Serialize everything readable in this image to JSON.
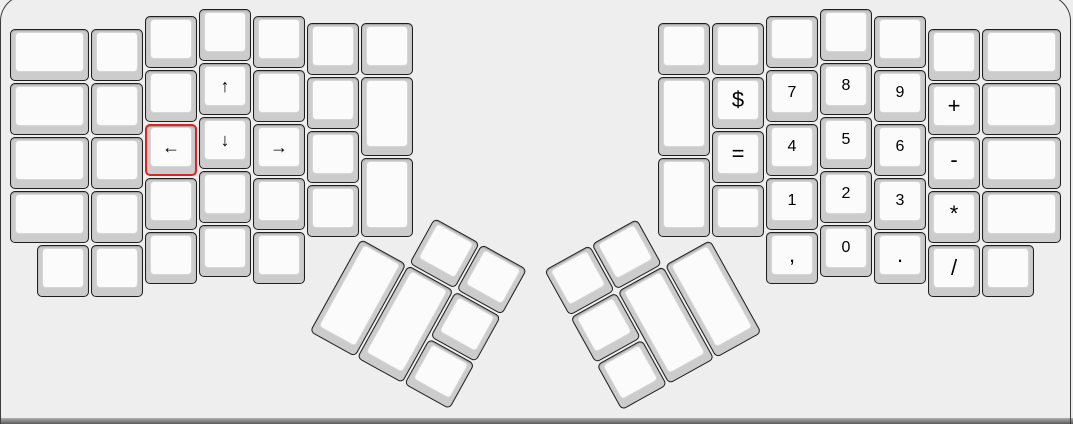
{
  "colors": {
    "page_background": "#eeeeee",
    "key_base": "#cccccc",
    "key_top": "#fbfbfb",
    "key_border": "#1f1f1f",
    "selected_key_border": "#e12222",
    "legend_color": "#000000",
    "panel_frame": "#3d3d3d",
    "bottom_edge": "#5a5a5a"
  },
  "keyboard": {
    "layout": {
      "unit_px": 54,
      "origin_x": 10,
      "origin_y": 9
    },
    "groups": [
      {
        "name": "left-main-keys",
        "rotation": 0,
        "keys": [
          {
            "x": 0,
            "y": 0.375,
            "w": 1.5,
            "label": ""
          },
          {
            "x": 0,
            "y": 1.375,
            "w": 1.5,
            "label": ""
          },
          {
            "x": 0,
            "y": 2.375,
            "w": 1.5,
            "label": ""
          },
          {
            "x": 0,
            "y": 3.375,
            "w": 1.5,
            "label": ""
          },
          {
            "x": 1.5,
            "y": 0.375,
            "label": ""
          },
          {
            "x": 1.5,
            "y": 1.375,
            "label": ""
          },
          {
            "x": 1.5,
            "y": 2.375,
            "label": ""
          },
          {
            "x": 1.5,
            "y": 3.375,
            "label": ""
          },
          {
            "x": 2.5,
            "y": 0.125,
            "label": ""
          },
          {
            "x": 2.5,
            "y": 1.125,
            "label": ""
          },
          {
            "x": 2.5,
            "y": 2.125,
            "label": "←",
            "cls": "arrow",
            "name": "key-left-arrow",
            "selected": true
          },
          {
            "x": 2.5,
            "y": 3.125,
            "label": ""
          },
          {
            "x": 3.5,
            "y": 0,
            "label": ""
          },
          {
            "x": 3.5,
            "y": 1,
            "label": "↑",
            "cls": "arrow",
            "name": "key-up-arrow"
          },
          {
            "x": 3.5,
            "y": 2,
            "label": "↓",
            "cls": "arrow",
            "name": "key-down-arrow"
          },
          {
            "x": 3.5,
            "y": 3,
            "label": ""
          },
          {
            "x": 4.5,
            "y": 0.125,
            "label": ""
          },
          {
            "x": 4.5,
            "y": 1.125,
            "label": ""
          },
          {
            "x": 4.5,
            "y": 2.125,
            "label": "→",
            "cls": "arrow",
            "name": "key-right-arrow"
          },
          {
            "x": 4.5,
            "y": 3.125,
            "label": ""
          },
          {
            "x": 5.5,
            "y": 0.25,
            "label": ""
          },
          {
            "x": 5.5,
            "y": 1.25,
            "label": ""
          },
          {
            "x": 5.5,
            "y": 2.25,
            "label": ""
          },
          {
            "x": 5.5,
            "y": 3.25,
            "label": ""
          },
          {
            "x": 6.5,
            "y": 0.25,
            "label": ""
          },
          {
            "x": 6.5,
            "y": 1.25,
            "h": 1.5,
            "label": ""
          },
          {
            "x": 6.5,
            "y": 2.75,
            "h": 1.5,
            "label": ""
          },
          {
            "x": 0.5,
            "y": 4.375,
            "label": ""
          },
          {
            "x": 1.5,
            "y": 4.375,
            "label": ""
          },
          {
            "x": 2.5,
            "y": 4.125,
            "label": ""
          },
          {
            "x": 3.5,
            "y": 4,
            "label": ""
          },
          {
            "x": 4.5,
            "y": 4.125,
            "label": ""
          }
        ]
      },
      {
        "name": "left-thumb-cluster",
        "rotation": 29,
        "center": {
          "x": 6.5,
          "y": 4.25
        },
        "keys": [
          {
            "x": 7.5,
            "y": 3.25,
            "label": ""
          },
          {
            "x": 8.5,
            "y": 3.25,
            "label": ""
          },
          {
            "x": 6.5,
            "y": 4.25,
            "h": 2,
            "label": ""
          },
          {
            "x": 7.5,
            "y": 4.25,
            "h": 2,
            "label": ""
          },
          {
            "x": 8.5,
            "y": 4.25,
            "label": ""
          },
          {
            "x": 8.5,
            "y": 5.25,
            "label": ""
          }
        ]
      },
      {
        "name": "right-main-keys",
        "rotation": 0,
        "keys": [
          {
            "x": 12,
            "y": 0.25,
            "label": ""
          },
          {
            "x": 12,
            "y": 1.25,
            "h": 1.5,
            "label": ""
          },
          {
            "x": 12,
            "y": 2.75,
            "h": 1.5,
            "label": ""
          },
          {
            "x": 13,
            "y": 0.25,
            "label": ""
          },
          {
            "x": 13,
            "y": 1.25,
            "label": "$",
            "cls": "symbol",
            "name": "key-dollar"
          },
          {
            "x": 13,
            "y": 2.25,
            "label": "=",
            "cls": "symbol",
            "name": "key-equals"
          },
          {
            "x": 13,
            "y": 3.25,
            "label": ""
          },
          {
            "x": 14,
            "y": 0.125,
            "label": ""
          },
          {
            "x": 14,
            "y": 1.125,
            "label": "7",
            "cls": "digit",
            "name": "key-7"
          },
          {
            "x": 14,
            "y": 2.125,
            "label": "4",
            "cls": "digit",
            "name": "key-4"
          },
          {
            "x": 14,
            "y": 3.125,
            "label": "1",
            "cls": "digit",
            "name": "key-1"
          },
          {
            "x": 15,
            "y": 0,
            "label": ""
          },
          {
            "x": 15,
            "y": 1,
            "label": "8",
            "cls": "digit",
            "name": "key-8"
          },
          {
            "x": 15,
            "y": 2,
            "label": "5",
            "cls": "digit",
            "name": "key-5"
          },
          {
            "x": 15,
            "y": 3,
            "label": "2",
            "cls": "digit",
            "name": "key-2"
          },
          {
            "x": 16,
            "y": 0.125,
            "label": ""
          },
          {
            "x": 16,
            "y": 1.125,
            "label": "9",
            "cls": "digit",
            "name": "key-9"
          },
          {
            "x": 16,
            "y": 2.125,
            "label": "6",
            "cls": "digit",
            "name": "key-6"
          },
          {
            "x": 16,
            "y": 3.125,
            "label": "3",
            "cls": "digit",
            "name": "key-3"
          },
          {
            "x": 17,
            "y": 0.375,
            "label": ""
          },
          {
            "x": 17,
            "y": 1.375,
            "label": "+",
            "cls": "symbol",
            "name": "key-plus"
          },
          {
            "x": 17,
            "y": 2.375,
            "label": "-",
            "cls": "symbol",
            "name": "key-minus"
          },
          {
            "x": 17,
            "y": 3.375,
            "label": "*",
            "cls": "symbol",
            "name": "key-asterisk"
          },
          {
            "x": 18,
            "y": 0.375,
            "w": 1.5,
            "label": ""
          },
          {
            "x": 18,
            "y": 1.375,
            "w": 1.5,
            "label": ""
          },
          {
            "x": 18,
            "y": 2.375,
            "w": 1.5,
            "label": ""
          },
          {
            "x": 18,
            "y": 3.375,
            "w": 1.5,
            "label": ""
          },
          {
            "x": 14,
            "y": 4.125,
            "label": ",",
            "cls": "symbol",
            "name": "key-comma"
          },
          {
            "x": 15,
            "y": 4,
            "label": "0",
            "cls": "digit",
            "name": "key-0"
          },
          {
            "x": 16,
            "y": 4.125,
            "label": ".",
            "cls": "symbol",
            "name": "key-period"
          },
          {
            "x": 17,
            "y": 4.375,
            "label": "/",
            "cls": "symbol",
            "name": "key-slash"
          },
          {
            "x": 18,
            "y": 4.375,
            "label": ""
          }
        ]
      },
      {
        "name": "right-thumb-cluster",
        "rotation": -29,
        "center": {
          "x": 13,
          "y": 4.25
        },
        "keys": [
          {
            "x": 10,
            "y": 3.25,
            "label": ""
          },
          {
            "x": 11,
            "y": 3.25,
            "label": ""
          },
          {
            "x": 10,
            "y": 4.25,
            "label": ""
          },
          {
            "x": 11,
            "y": 4.25,
            "h": 2,
            "label": ""
          },
          {
            "x": 12,
            "y": 4.25,
            "h": 2,
            "label": ""
          },
          {
            "x": 10,
            "y": 5.25,
            "label": ""
          }
        ]
      }
    ]
  }
}
